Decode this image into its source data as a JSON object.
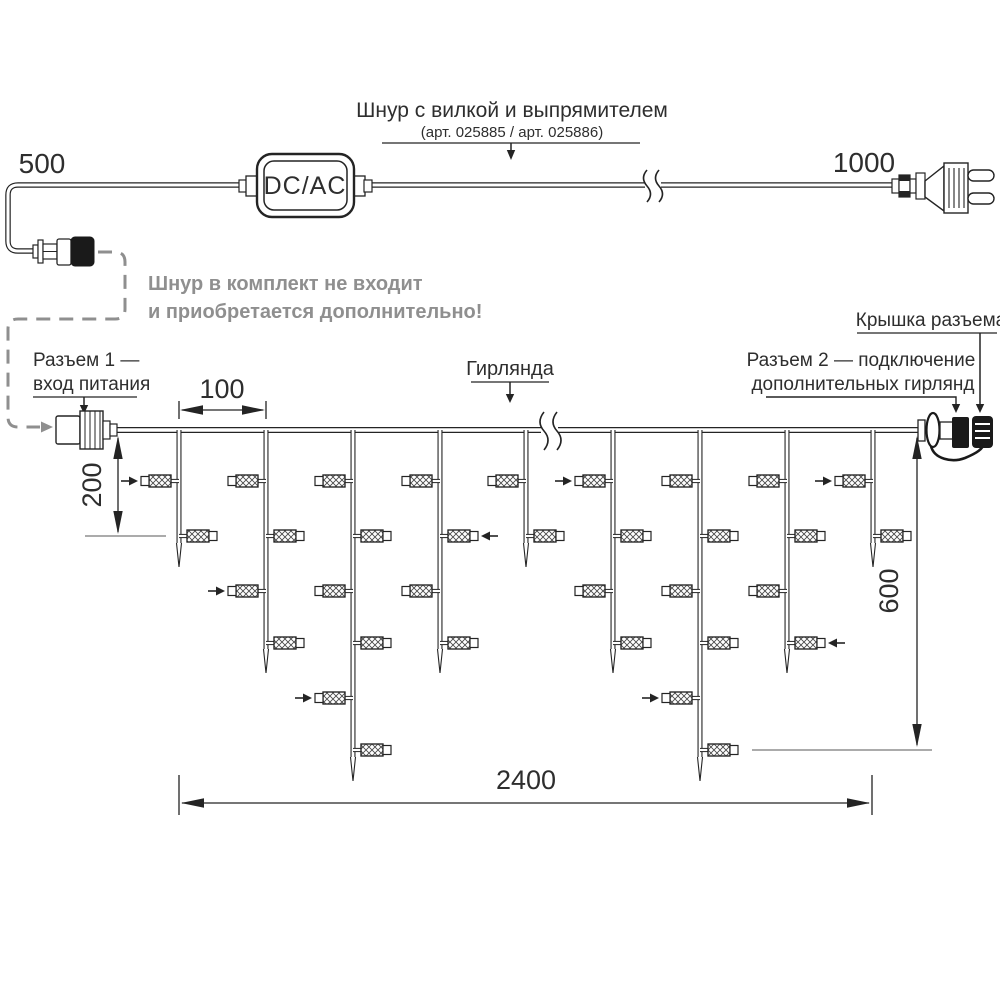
{
  "colors": {
    "ink": "#242424",
    "gray": "#8f8f8f",
    "background": "#ffffff"
  },
  "power_cord": {
    "left_length": "500",
    "right_length": "1000",
    "adapter": "DC/AC",
    "callout_title": "Шнур с вилкой и выпрямителем",
    "callout_subtitle": "(арт. 025885 / арт. 025886)",
    "note_line1": "Шнур в комплект не входит",
    "note_line2": "и приобретается дополнительно!"
  },
  "garland": {
    "connector1_line1": "Разъем 1 —",
    "connector1_line2": "вход питания",
    "name_label": "Гирлянда",
    "connector2_line1": "Разъем 2 — подключение",
    "connector2_line2": "дополнительных гирлянд",
    "cap_label": "Крышка разъема"
  },
  "dimensions": {
    "drop_spacing": "100",
    "short_drop": "200",
    "long_drop": "600",
    "total_width": "2400"
  },
  "diagram": {
    "wire": {
      "x1": 116,
      "x2": 918,
      "y": 430
    },
    "bulb_rows": [
      481,
      536,
      591,
      643,
      698,
      750
    ],
    "sizes": {
      "S": {
        "bulbs": 2,
        "tip": 567
      },
      "M": {
        "bulbs": 4,
        "tip": 673
      },
      "L": {
        "bulbs": 6,
        "tip": 781
      }
    },
    "drops": [
      {
        "x": 179,
        "size": "S",
        "arrow_row": 0
      },
      {
        "x": 266,
        "size": "M",
        "arrow_row": 2
      },
      {
        "x": 353,
        "size": "L",
        "arrow_row": 4
      },
      {
        "x": 440,
        "size": "M",
        "arrow_row": 1
      },
      {
        "x": 526,
        "size": "S",
        "arrow_row": null
      },
      {
        "x": 613,
        "size": "M",
        "arrow_row": 0
      },
      {
        "x": 700,
        "size": "L",
        "arrow_row": 4
      },
      {
        "x": 787,
        "size": "M",
        "arrow_row": 3
      },
      {
        "x": 873,
        "size": "S",
        "arrow_row": 0
      }
    ],
    "break_x": 549
  }
}
